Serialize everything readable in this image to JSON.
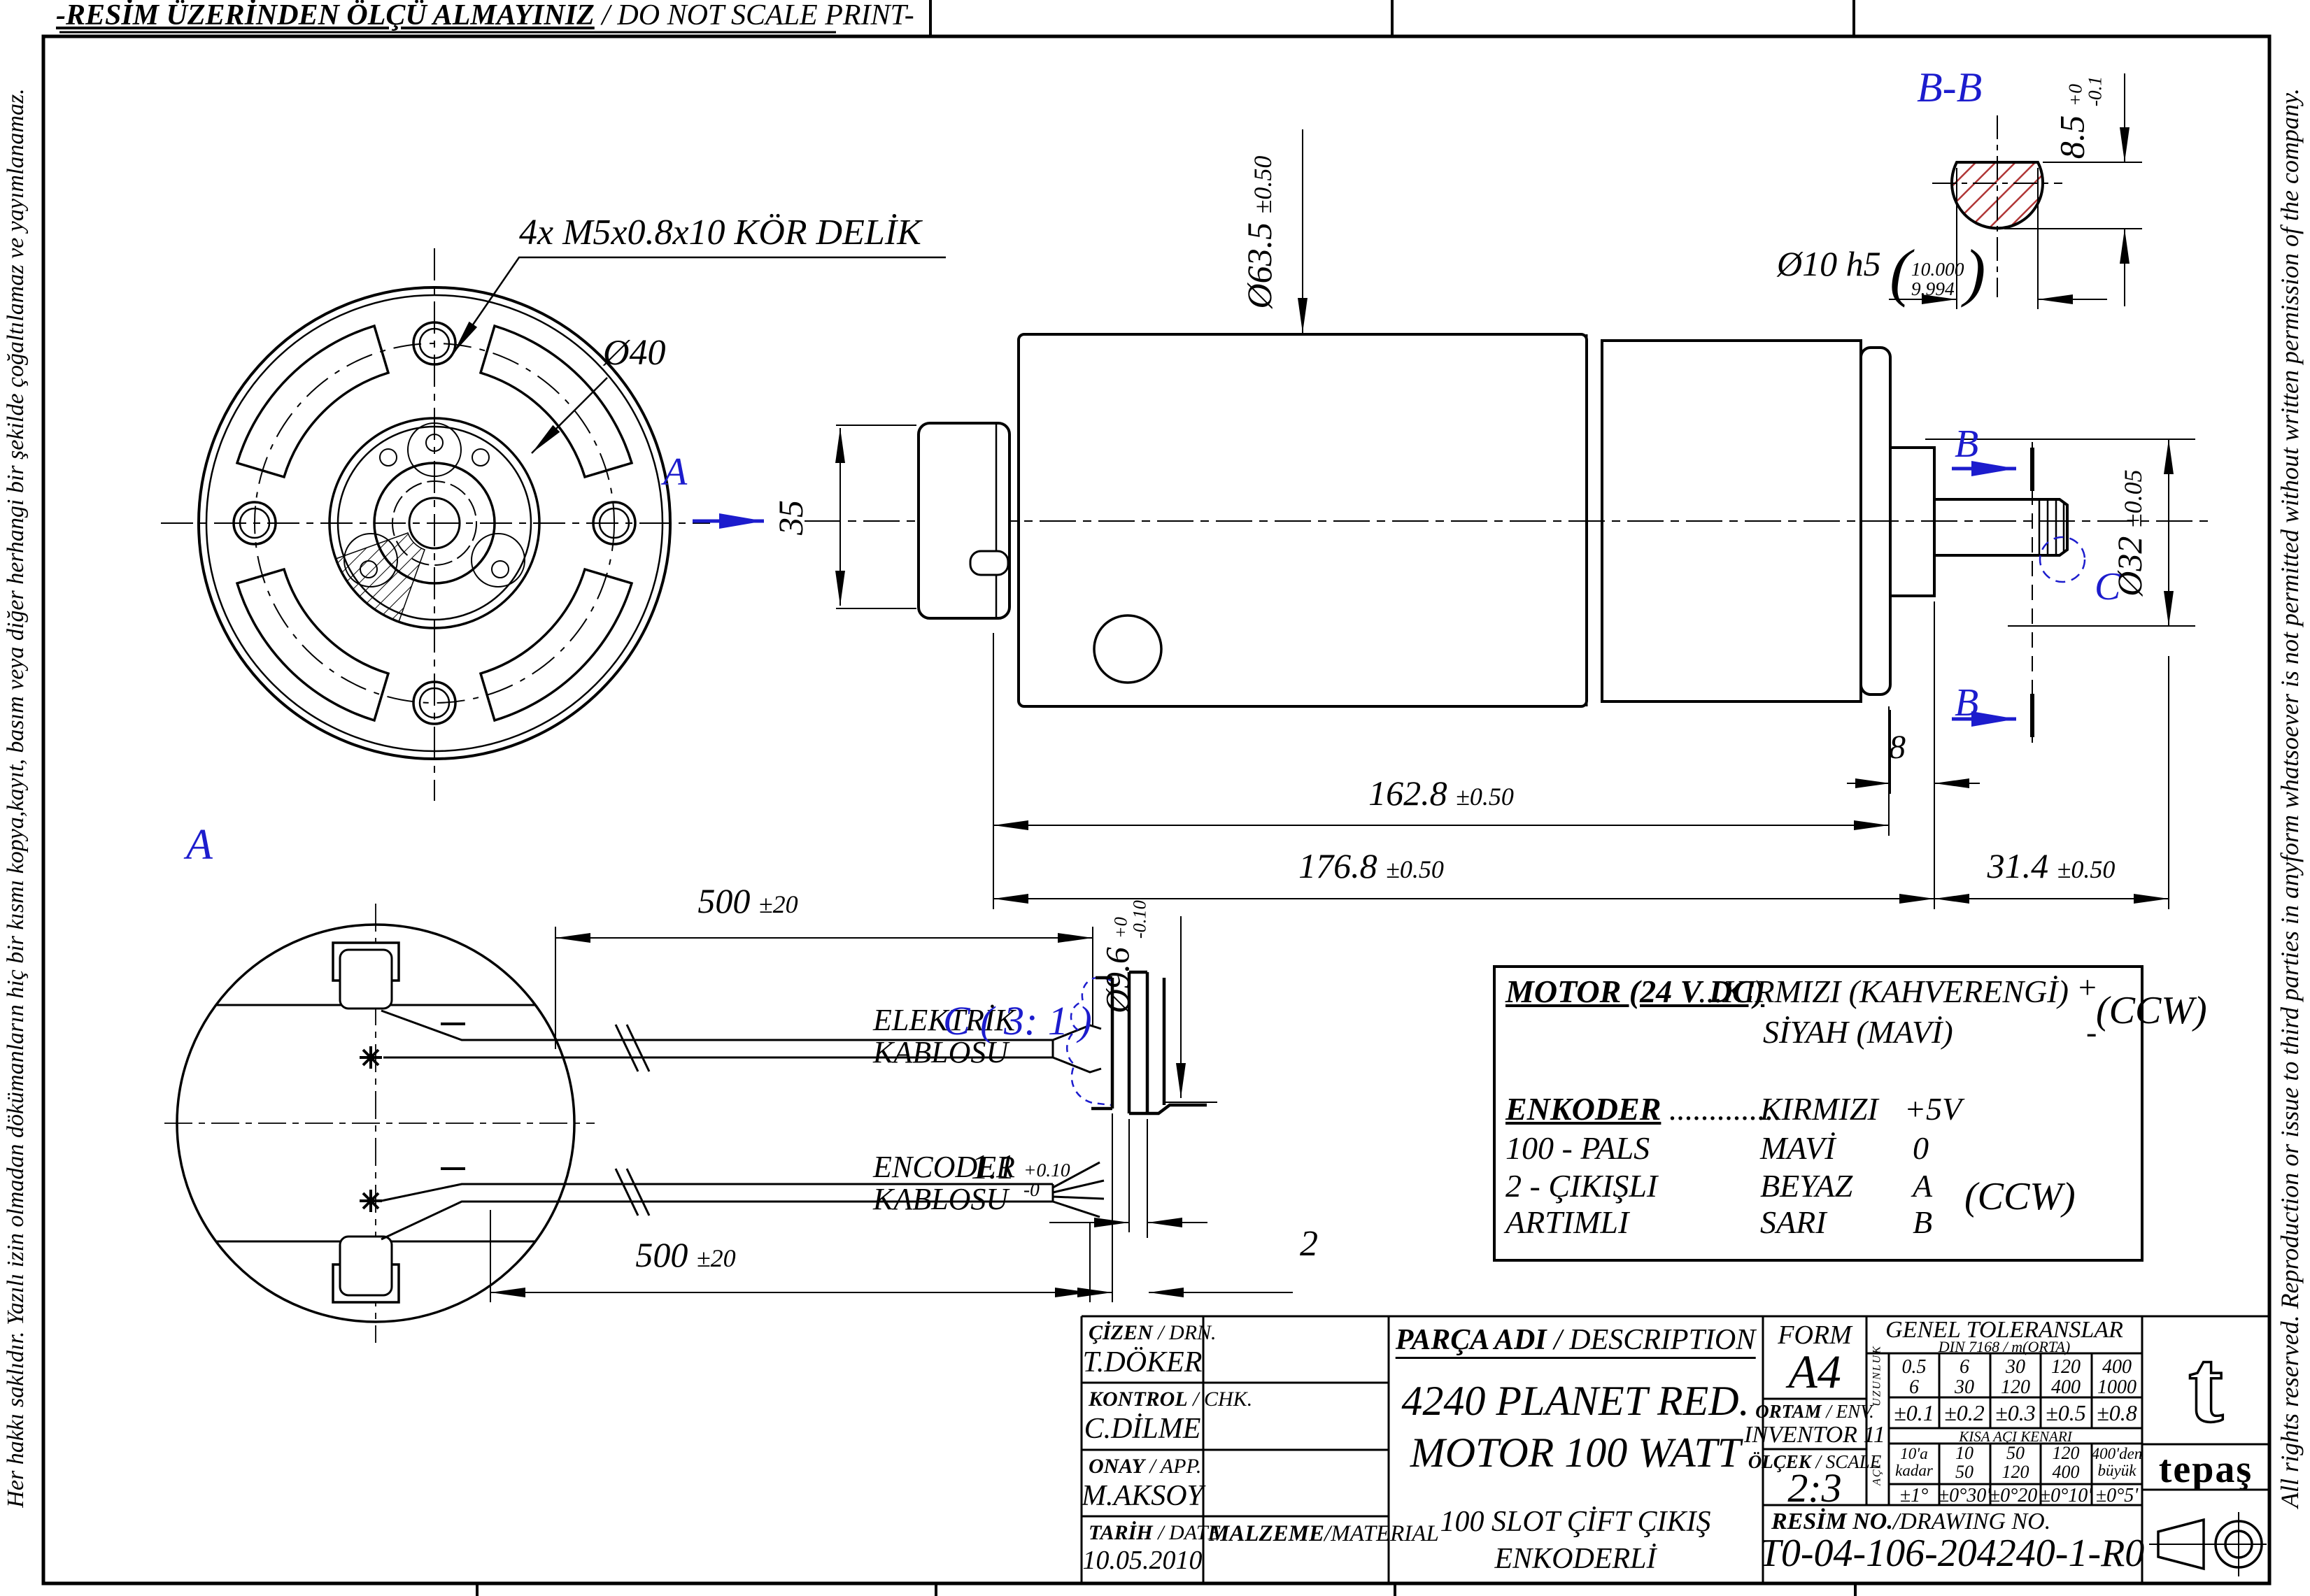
{
  "colors": {
    "accent_blue": "#1c1ccd",
    "hatch_red": "#b03636",
    "line_black": "#000000"
  },
  "header": {
    "warning_tr": "-RESİM ÜZERİNDEN ÖLÇÜ ALMAYINIZ",
    "warning_en": " / DO NOT SCALE PRINT-"
  },
  "side_notes": {
    "left": "Her hakkı saklıdır. Yazılı izin olmadan dökümanların hiç bir kısmı kopya,kayıt, basım veya diğer herhangi bir şekilde çoğaltılamaz ve yayımlanamaz.",
    "right": "All rights reserved. Reproduction or issue to third parties in anyform whatsoever is not permitted without written permission of the company."
  },
  "front_view": {
    "callout_holes": "4x M5x0.8x10 KÖR DELİK",
    "callout_bolt_circle": "Ø40"
  },
  "side_view": {
    "label_a": "A",
    "label_b": "B",
    "label_c": "C",
    "dim_body_dia": {
      "v": "Ø63.5",
      "t": "±0.50"
    },
    "dim_pilot": "35",
    "dim_rear_dia": {
      "v": "Ø32",
      "t": "±0.05"
    },
    "dim_boss_len": "8",
    "dim_gearbox_len": {
      "v": "162.8",
      "t": "±0.50"
    },
    "dim_total_len": {
      "v": "176.8",
      "t": "±0.50"
    },
    "dim_shaft_len": {
      "v": "31.4",
      "t": "±0.50"
    }
  },
  "section_bb": {
    "title": "B-B",
    "dim_flat": {
      "v": "8.5",
      "up": "+0",
      "dn": "-0.1"
    },
    "dim_dia": {
      "v": "Ø10 h5",
      "up": "10.000",
      "dn": "9.994"
    }
  },
  "section_a": {
    "title": "A",
    "dim_cable_top": {
      "v": "500",
      "t": "±20"
    },
    "dim_cable_bottom": {
      "v": "500",
      "t": "±20"
    },
    "label_power": "ELEKTRİK\nKABLOSU",
    "label_encoder": "ENCODER\nKABLOSU"
  },
  "detail_c": {
    "title": "C  ( 3: 1 )",
    "dim_dia": {
      "v": "Ø9.6",
      "up": "+0",
      "dn": "-0.10"
    },
    "dim_width": {
      "v": "1.1",
      "up": "+0.10",
      "dn": "-0"
    },
    "dim_depth": "2"
  },
  "connection_table": {
    "motor_title": "MOTOR (24 V DC)",
    "motor_wire_pos": "...KIRMIZI (KAHVERENGİ)",
    "motor_sign_pos": "+",
    "motor_wire_neg": "SİYAH (MAVİ)",
    "motor_sign_neg": "-",
    "motor_dir": "(CCW)",
    "enc_title": "ENKODER",
    "enc_dots": "..............",
    "enc_wire": "KIRMIZI",
    "enc_sig": "+5V",
    "enc_rows": [
      {
        "label": "100  - PALS",
        "wire": "MAVİ",
        "sig": "0"
      },
      {
        "label": "2 - ÇIKIŞLI",
        "wire": "BEYAZ",
        "sig": "A"
      },
      {
        "label": "ARTIMLI",
        "wire": "SARI",
        "sig": "B"
      }
    ],
    "enc_dir": "(CCW)"
  },
  "title_block": {
    "drn": {
      "b": "ÇİZEN",
      "r": " / DRN.",
      "v": "T.DÖKER"
    },
    "chk": {
      "b": "KONTROL",
      "r": " / CHK.",
      "v": "C.DİLME"
    },
    "app": {
      "b": "ONAY",
      "r": " / APP.",
      "v": "M.AKSOY"
    },
    "date": {
      "b": "TARİH",
      "r": " / DATE",
      "v": "10.05.2010"
    },
    "material": {
      "b": "MALZEME",
      "r": "/MATERIAL"
    },
    "desc": {
      "b": "PARÇA ADI",
      "r": " / DESCRIPTION",
      "line1": "4240 PLANET RED.",
      "line2": "MOTOR 100 WATT",
      "sub": "100 SLOT ÇİFT ÇIKIŞ\nENKODERLİ"
    },
    "form": {
      "label": "FORM",
      "v": "A4"
    },
    "env": {
      "b": "ORTAM",
      "r": " / ENV.",
      "v": "INVENTOR 11"
    },
    "scale": {
      "b": "ÖLÇEK",
      "r": " / SCALE",
      "v": "2:3"
    },
    "resim": {
      "b": "RESİM NO.",
      "r": "/DRAWING NO.",
      "v": "T0-04-106-204240-1-R0"
    },
    "logo": "tepaş",
    "logo_t": "t"
  },
  "tolerances": {
    "title": "GENEL TOLERANSLAR",
    "subtitle": "DIN 7168 / m(ORTA)",
    "len_label": "UZUNLUK",
    "ang_label": "AÇI",
    "len_ranges": [
      {
        "a": "0.5",
        "b": "6"
      },
      {
        "a": "6",
        "b": "30"
      },
      {
        "a": "30",
        "b": "120"
      },
      {
        "a": "120",
        "b": "400"
      },
      {
        "a": "400",
        "b": "1000"
      }
    ],
    "len_tols": [
      "±0.1",
      "±0.2",
      "±0.3",
      "±0.5",
      "±0.8"
    ],
    "ang_header": "KISA AÇI KENARI",
    "ang_ranges": [
      {
        "a": "10'a",
        "b": "kadar"
      },
      {
        "a": "10",
        "b": "50"
      },
      {
        "a": "50",
        "b": "120"
      },
      {
        "a": "120",
        "b": "400"
      },
      {
        "a": "400'den",
        "b": "büyük"
      }
    ],
    "ang_tols": [
      "±1°",
      "±0°30'",
      "±0°20'",
      "±0°10'",
      "±0°5'"
    ]
  }
}
